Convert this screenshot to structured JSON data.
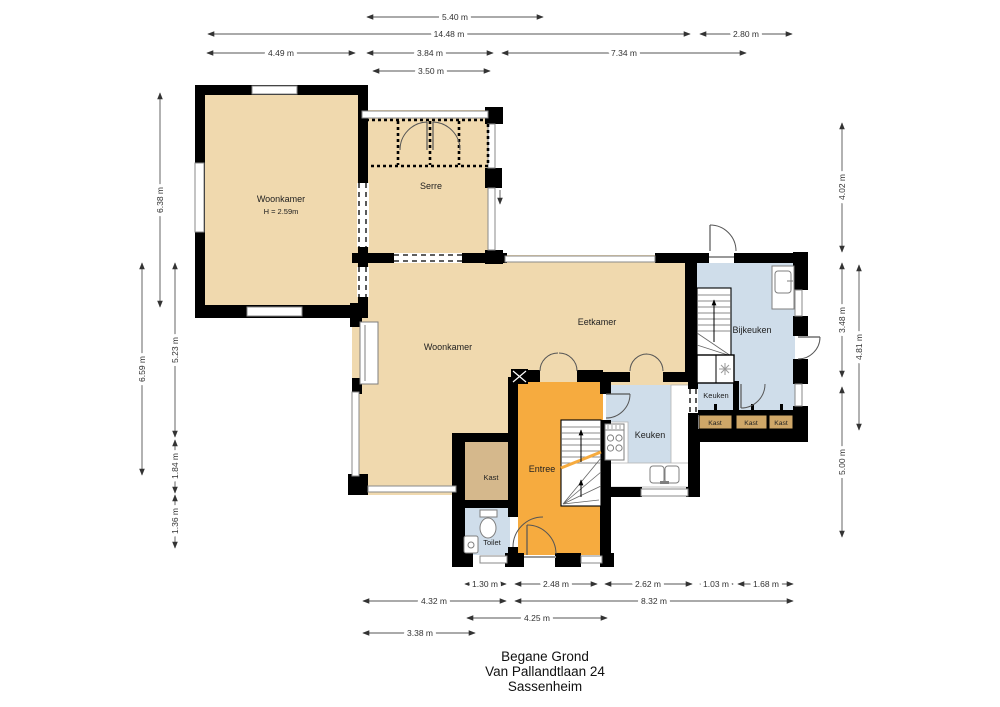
{
  "plan": {
    "rooms": {
      "woonkamer_nw": {
        "label": "Woonkamer",
        "ceiling": "H = 2.59m"
      },
      "serre": {
        "label": "Serre"
      },
      "woonkamer": {
        "label": "Woonkamer"
      },
      "eetkamer": {
        "label": "Eetkamer"
      },
      "keuken": {
        "label": "Keuken"
      },
      "keuken_klein": {
        "label": "Keuken"
      },
      "bijkeuken": {
        "label": "Bijkeuken"
      },
      "entree": {
        "label": "Entree"
      },
      "kast": {
        "label": "Kast"
      },
      "toilet": {
        "label": "Toilet"
      },
      "kast_links": {
        "label": "Kast"
      },
      "kast_midden": {
        "label": "Kast"
      },
      "kast_rechts": {
        "label": "Kast"
      }
    }
  },
  "dimensions": {
    "top": [
      {
        "label": "5.40 m"
      },
      {
        "label": "14.48 m"
      },
      {
        "label": "2.80 m"
      },
      {
        "label": "4.49 m"
      },
      {
        "label": "3.84 m"
      },
      {
        "label": "7.34 m"
      },
      {
        "label": "3.50 m"
      }
    ],
    "bottom": [
      {
        "label": "1.30 m"
      },
      {
        "label": "2.48 m"
      },
      {
        "label": "2.62 m"
      },
      {
        "label": "1.03 m"
      },
      {
        "label": "1.68 m"
      },
      {
        "label": "4.32 m"
      },
      {
        "label": "8.32 m"
      },
      {
        "label": "4.25 m"
      },
      {
        "label": "3.38 m"
      }
    ],
    "left": [
      {
        "label": "6.38 m"
      },
      {
        "label": "6.59 m"
      },
      {
        "label": "5.23 m"
      },
      {
        "label": "1.84 m"
      },
      {
        "label": "1.36 m"
      }
    ],
    "right": [
      {
        "label": "4.02 m"
      },
      {
        "label": "3.48 m"
      },
      {
        "label": "4.81 m"
      },
      {
        "label": "5.00 m"
      }
    ]
  },
  "footer": {
    "line1": "Begane Grond",
    "line2": "Van Pallandtlaan 24",
    "line3": "Sassenheim"
  },
  "colors": {
    "floor_beige": "#F0D9AE",
    "entree_orange": "#F6AB3F",
    "closet_tan": "#D5B88C",
    "kast_box_tan": "#CFA768",
    "wet_room_blue": "#CFDDEA",
    "wall_black": "#000000"
  }
}
